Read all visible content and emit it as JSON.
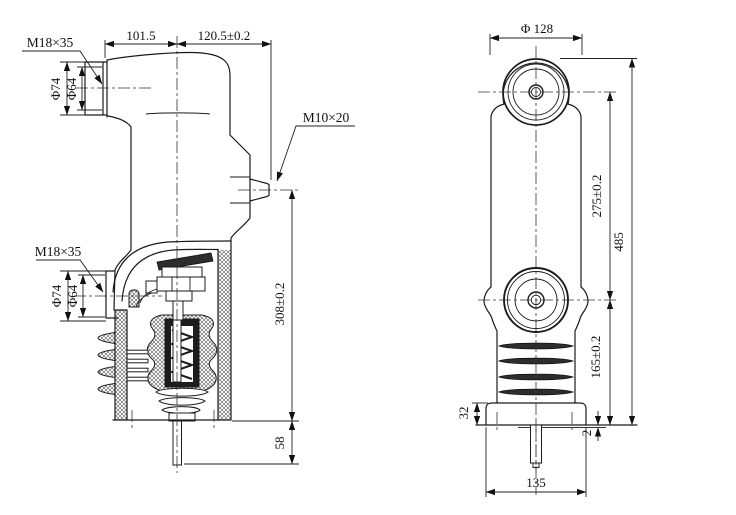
{
  "drawing": {
    "kind": "technical-drawing",
    "background": "#ffffff",
    "line_color": "#1a1a1a"
  },
  "side_view": {
    "label_m18_upper": "M18×35",
    "label_dia74_upper": "Φ74",
    "label_dia64_upper": "Φ64",
    "dim_top_left": "101.5",
    "dim_top_right": "120.5±0.2",
    "label_m10": "M10×20",
    "label_m18_lower": "M18×35",
    "label_dia74_lower": "Φ74",
    "label_dia64_lower": "Φ64",
    "dim_height": "308±0.2",
    "dim_stem": "58"
  },
  "front_view": {
    "dim_top_dia": "Φ 128",
    "dim_terminal_spacing": "275±0.2",
    "dim_total_height": "485",
    "dim_lower_height": "165±0.2",
    "dim_flange_height": "32",
    "dim_base_step": "2",
    "dim_flange_width": "135"
  }
}
